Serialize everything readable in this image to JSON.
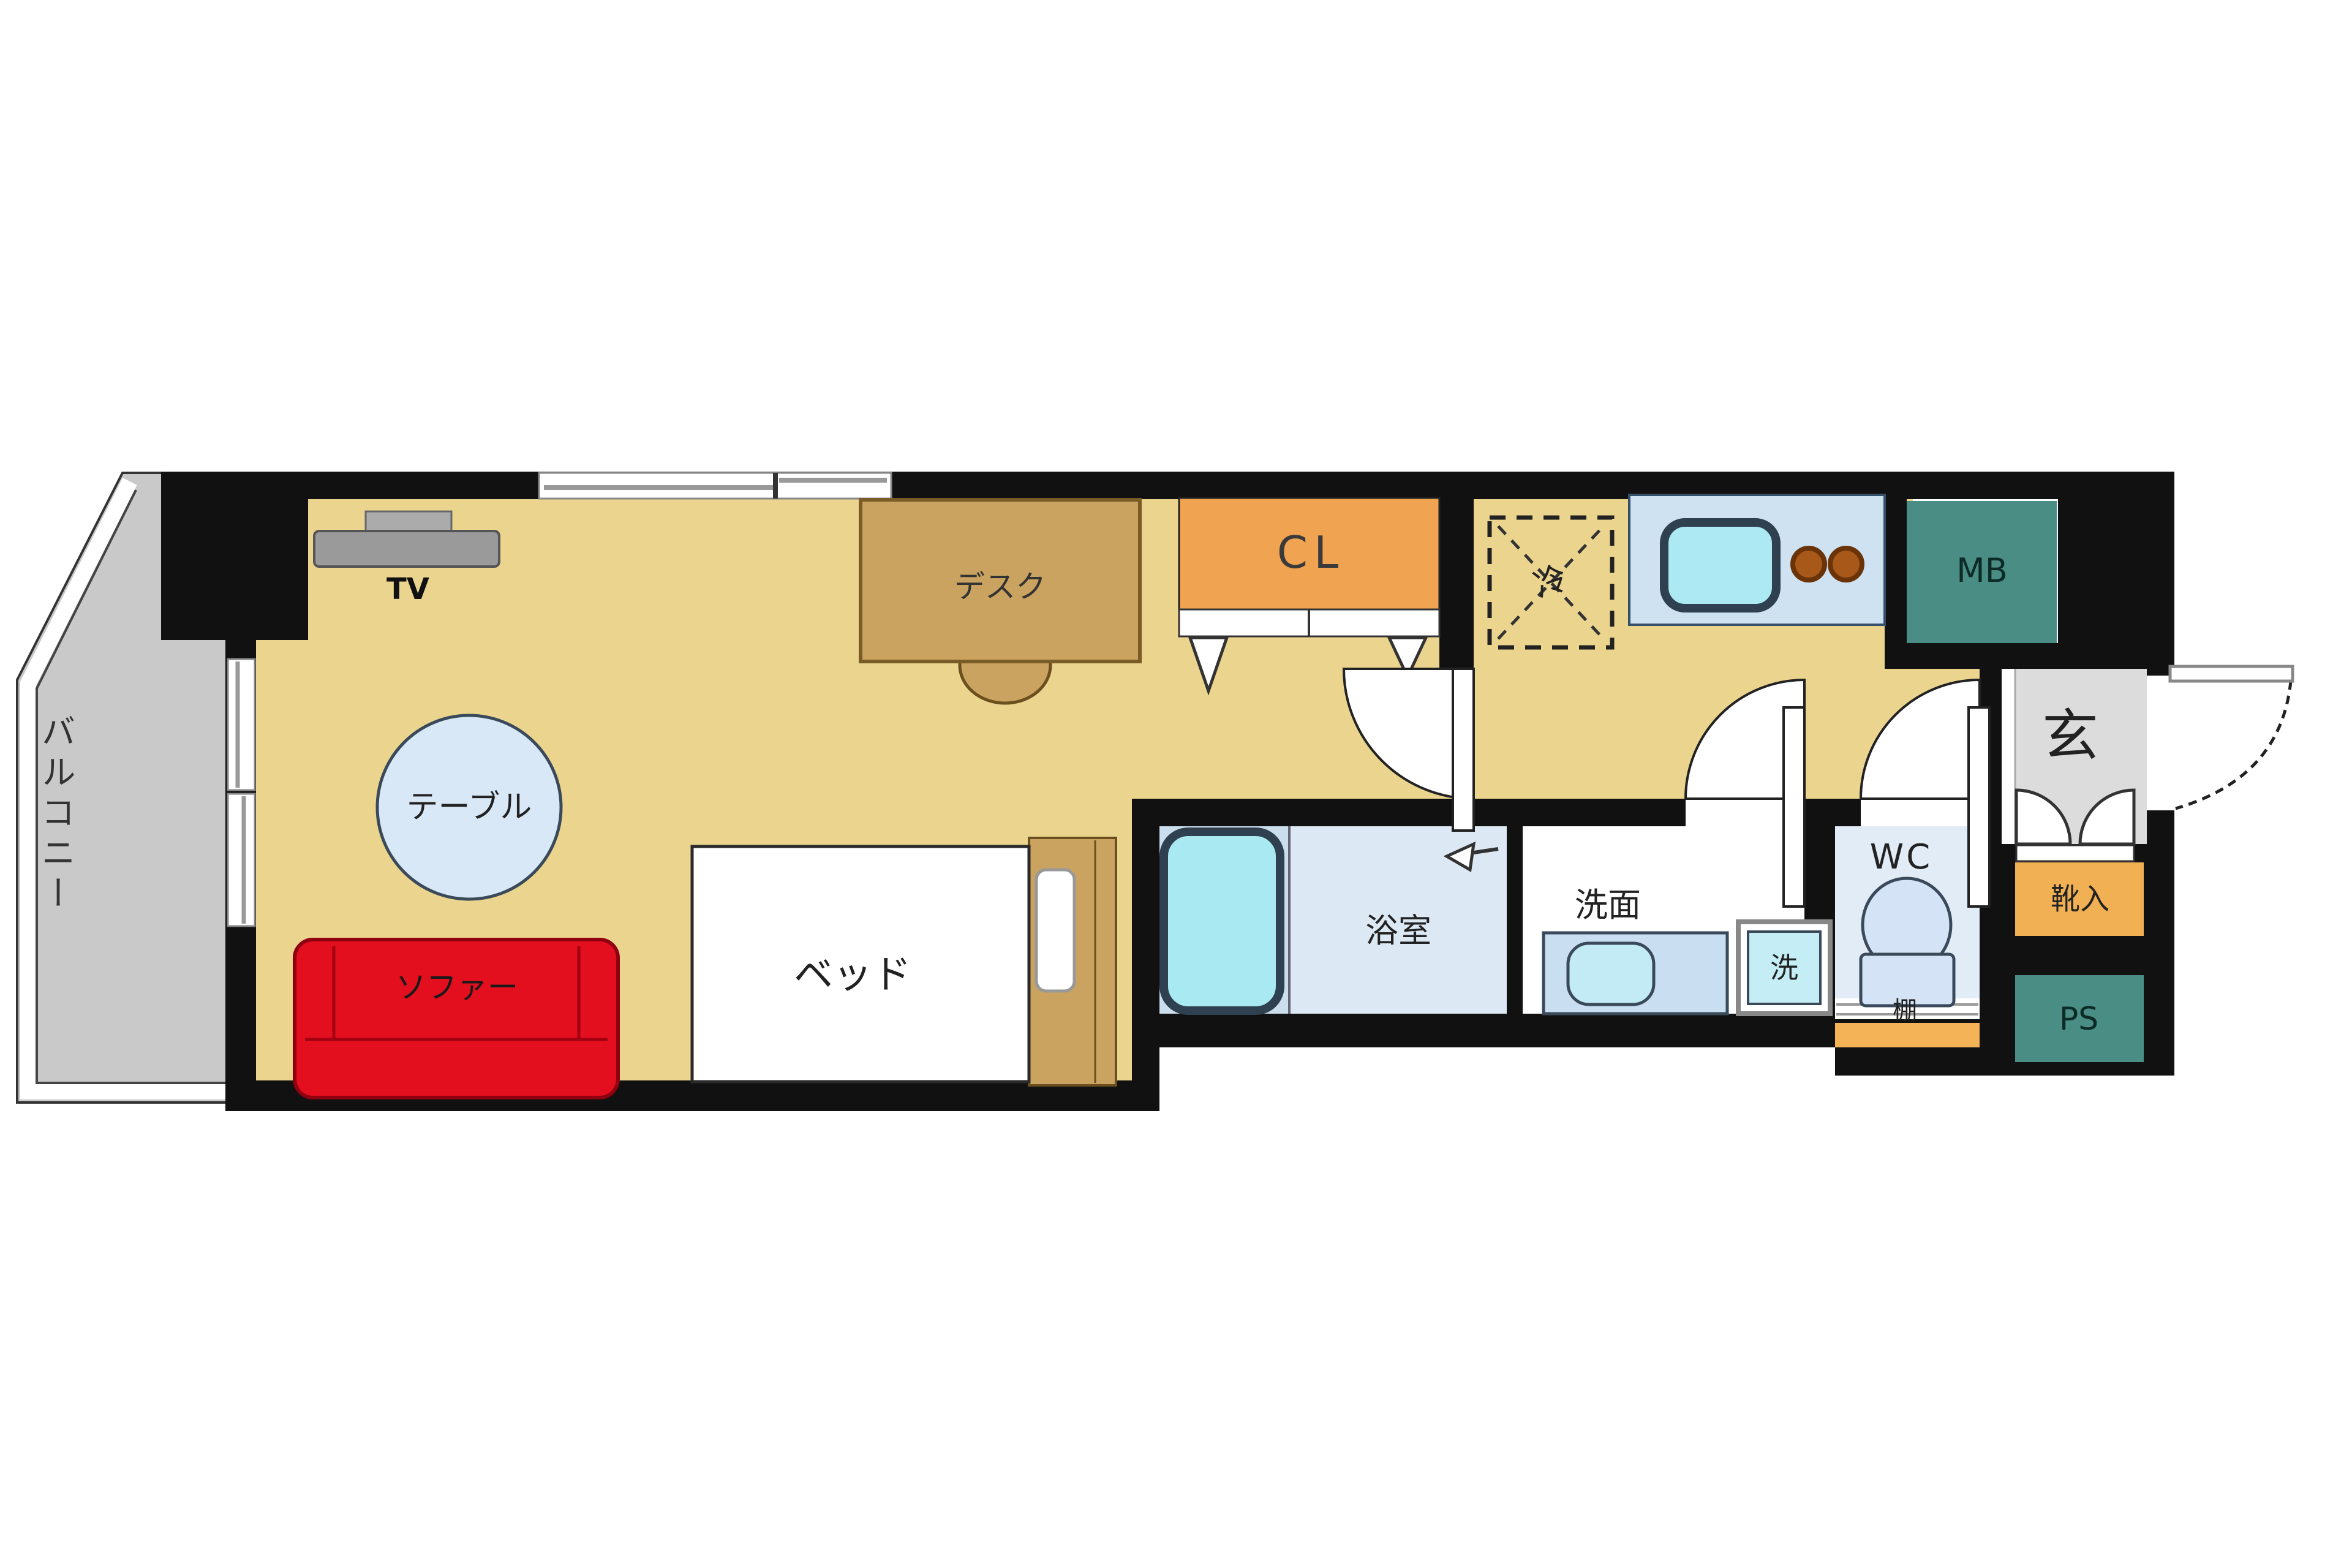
{
  "document": {
    "kind": "apartment floor plan (1K layout)"
  },
  "labels": {
    "balcony": "バルコニー",
    "tv": "TV",
    "table": "テーブル",
    "sofa": "ソファー",
    "bed": "ベッド",
    "desk": "デスク",
    "closet": "CL",
    "fridge": "冷",
    "meter_box": "MB",
    "bathroom": "浴室",
    "washroom": "洗面",
    "washing_machine": "洗",
    "toilet": "WC",
    "toilet_shelf": "棚",
    "entrance": "玄",
    "shoe_cabinet": "靴入",
    "pipe_space": "PS"
  },
  "colors": {
    "wall": "#111111",
    "room_floor": "#EBD58E",
    "balcony_gray": "#C9C9C9",
    "entrance_gray": "#DCDCDC",
    "closet_orange": "#F0A351",
    "shoe_orange": "#F2B054",
    "teal_shaft": "#4A8D84",
    "bath_floor": "#DCE9F4",
    "tub_cyan": "#A9E9F2",
    "wc_floor": "#E2ECF7",
    "kitchen_counter": "#CFE2F2",
    "burner_brown": "#A85818",
    "sofa_red": "#E30E1E",
    "wood_tan": "#C9A35F",
    "table_blue": "#D9E8F6"
  }
}
